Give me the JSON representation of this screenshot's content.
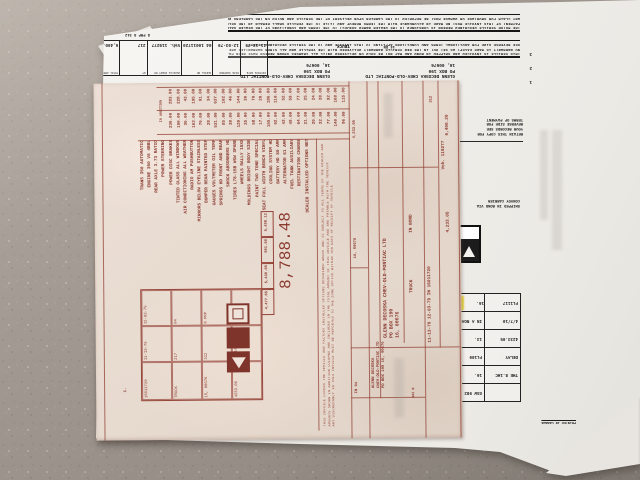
{
  "white_invoice": {
    "terms_top": [
      "THE MOTOR VEHICLE DESCRIBED HEREON IS CONSIGNED TO THE DEALER NAMED SUBJECT TO THE TERMS AND CONDITIONS OF THE DEALER SALES AND SERVICE AGREEMENT",
      "PAYMENT OF THIS INVOICE MUST BE MADE IN ACCORDANCE WITH THE TERMS HEREOF AND TITLE TO THE VEHICLE SHALL REMAIN IN THE SELLER UNTIL FULL PAYMENT RECEIVED",
      "ANY CLAIM FOR SHORTAGE OR DAMAGE MUST BE REPORTED TO THE CARRIER UPON DELIVERY OF THE VEHICLE AND NOTED ON THE CARRIERS DELIVERY RECEIPT"
    ],
    "terms_bottom": [
      "THIS VEHICLE IS INVOICED AND SHIPPED IN BOND AND MAY NOT BE SOLD OR DELIVERED UNTIL ALL CHARGES SHOWN HEREON HAVE BEEN PAID IN FULL TO THE SELLER",
      "NO WARRANTY IS MADE EXCEPT AS SET OUT IN THE NEW VEHICLE WARRANTY DELIVERED WITH THE VEHICLE AND ALL OTHER WARRANTIES ARE EXPRESSLY EXCLUDED",
      "SEE REVERSE SIDE FOR ADDITIONAL TERMS AND CONDITIONS APPLYING TO THIS INVOICE AND TO THE VEHICLE DESCRIBED HEREON"
    ],
    "page_numbers": [
      "1",
      "2",
      "3"
    ],
    "header": {
      "columns": [
        {
          "label": "INVOICE DATE",
          "value": "11-13-79"
        },
        {
          "label": "DATE SHIPPED",
          "value": "12-03-79"
        },
        {
          "label": "SERIAL NO",
          "value": "04 16011720"
        },
        {
          "label": "VEHICLE IDENT NO",
          "value": "Veh. 119277"
        },
        {
          "label": "WT",
          "value": "217"
        },
        {
          "label": "TOTAL AMOUNT",
          "value": "6,400.20"
        }
      ],
      "aux_code": "8 PRP 8   312"
    },
    "sold_to": [
      "GLENN DECOSKA CHEV-OLD-PONTIAC LTD",
      "PO BOX 190",
      "16, 00676"
    ],
    "ship_to": [
      "GLENN DECOSKA CHEV-OLD-PONTIAC LTD",
      "PO BOX 190",
      "16, 00676"
    ],
    "vehicle_type": "TRUCK",
    "bond_code": "14 DN",
    "notice_a": [
      "RETAIN THIS COPY FOR",
      "YOUR RECORDS SEE",
      "REVERSE SIDE FOR",
      "TERMS OF PAYMENT"
    ],
    "notice_b": [
      "SHIPPED IN BOND VIA",
      "CONVOY CARRIER"
    ],
    "ship_table_rows": [
      [
        "",
        "GSW 982"
      ],
      [
        "THE 8.1HC",
        "16."
      ],
      [
        "DELAY",
        "FL100"
      ],
      [
        "4233.05",
        "13."
      ],
      [
        "4/7/10",
        "IN A ROAD"
      ],
      [
        "FL1117",
        "16."
      ]
    ],
    "footer_small": "PRINTED IN CANADA"
  },
  "pink_invoice": {
    "margin_mark": "1.",
    "grid_cells": [
      "16011720",
      "11-13-79",
      "12-03-79",
      "TRUCK",
      "217",
      "04",
      "16, 00676",
      "312",
      "8 PRP",
      "4233.05",
      "DN 14",
      ""
    ],
    "options": [
      "TRANS 350 AUTOMATIC",
      "ENGINE 350 V8 4BBL",
      "REAR AXLE 3.73 RATIO",
      "POWER STEERING",
      "POWER DISC BRAKES",
      "TINTED GLASS ALL WINDOWS",
      "AIR CONDITIONING ALL WEATHER",
      "RADIO AM PUSHBUTTON",
      "MIRRORS BELOW EYELINE STAINLESS",
      "BUMPER REAR PAINTED STEP",
      "GAUGES VOLTMETER OIL TEMP",
      "SPRINGS HD FRONT AND REAR",
      "SHOCK ABSORBERS HD",
      "TIRES L78-15B WSW SPARE",
      "WHEELS RALLY 15X8",
      "MOLDINGS BRIGHT BODY SIDE",
      "PAINT TWO TONE SPECIAL",
      "SEAT FULL WIDTH BENCH VINYL",
      "COOLING SYSTEM HD",
      "BATTERY HD 80 AMP",
      "ALTERNATOR 61 AMP",
      "FUEL TANK AUXILIARY",
      "DESTINATION CHARGE",
      "DEALER INSTALLED OPTIONS NET"
    ],
    "price_col_header": "IN ADDITION",
    "prices_a": [
      "236.00",
      "190.00",
      "36.00",
      "163.00",
      "76.00",
      "28.00",
      "531.00",
      "85.00",
      "38.00",
      "120.00",
      "25.00",
      "58.00",
      "17.00",
      "155.00",
      "92.00",
      "43.00",
      "49.00",
      "64.00",
      "21.00",
      "20.00",
      "32.00",
      "77.00",
      "140.00",
      "96.00"
    ],
    "prices_b": [
      "283.00",
      "228.00",
      "43.00",
      "195.00",
      "91.00",
      "34.00",
      "637.00",
      "102.00",
      "46.00",
      "144.00",
      "30.00",
      "70.00",
      "20.00",
      "186.00",
      "110.00",
      "52.00",
      "59.00",
      "77.00",
      "25.00",
      "24.00",
      "38.00",
      "92.00",
      "168.00",
      "115.00"
    ],
    "totals_cells": [
      "4,477.65",
      "5,439.05",
      "591.50",
      "5,498.12"
    ],
    "totals_extra": "8,788.48",
    "fine_print": [
      "THIS INVOICE COVERS THE VEHICLE AND FACTORY INSTALLED OPTIONS DESCRIBED ABOVE AND IS SUBJECT TO ALL TERMS OF THE DEALER AGREEMENT",
      "AMOUNTS SHOWN IN ADDITION COLUMNS ARE INCLUDED IN THE TOTAL AMOUNT OF THIS INVOICE AND ARE PAYABLE WITH THE VEHICLE",
      "ANY DISCREPANCY IN THIS INVOICE MUST BE REPORTED TO THE ZONE OFFICE WITHIN TEN DAYS OF RECEIPT OF VEHICLE"
    ],
    "band_val_1": "IN 04",
    "band_val_2": "16, 00676",
    "band_val_3": "4,233.05",
    "sold_to_small": [
      "GLENN DECOSKA",
      "CHEV-OLD-PONTIAC LTD",
      "PO BOX 190  16, 00676"
    ],
    "ship_to_large": [
      "GLENN DECOSKA CHEV-OLD-PONTIAC LTD",
      "PO BOX 190",
      "16, 00676"
    ],
    "vehicle_type": "TRUCK",
    "bond": "IN BOND",
    "dates_row": "11-13-79  12-03-79  IN  16011720",
    "vehicle_no": "Veh. 119277",
    "amount_due": "6,400.20",
    "code": "312",
    "amount_2": "4,233.05",
    "form_no": "902 B"
  },
  "colors": {
    "red_ink": "#8c3a30",
    "black_ink": "#1b1b1b",
    "highlight_yellow": "#ebd426",
    "pink_paper": "#e7dacf",
    "white_paper": "#f2f0ec",
    "carpet": "#a29a92"
  }
}
